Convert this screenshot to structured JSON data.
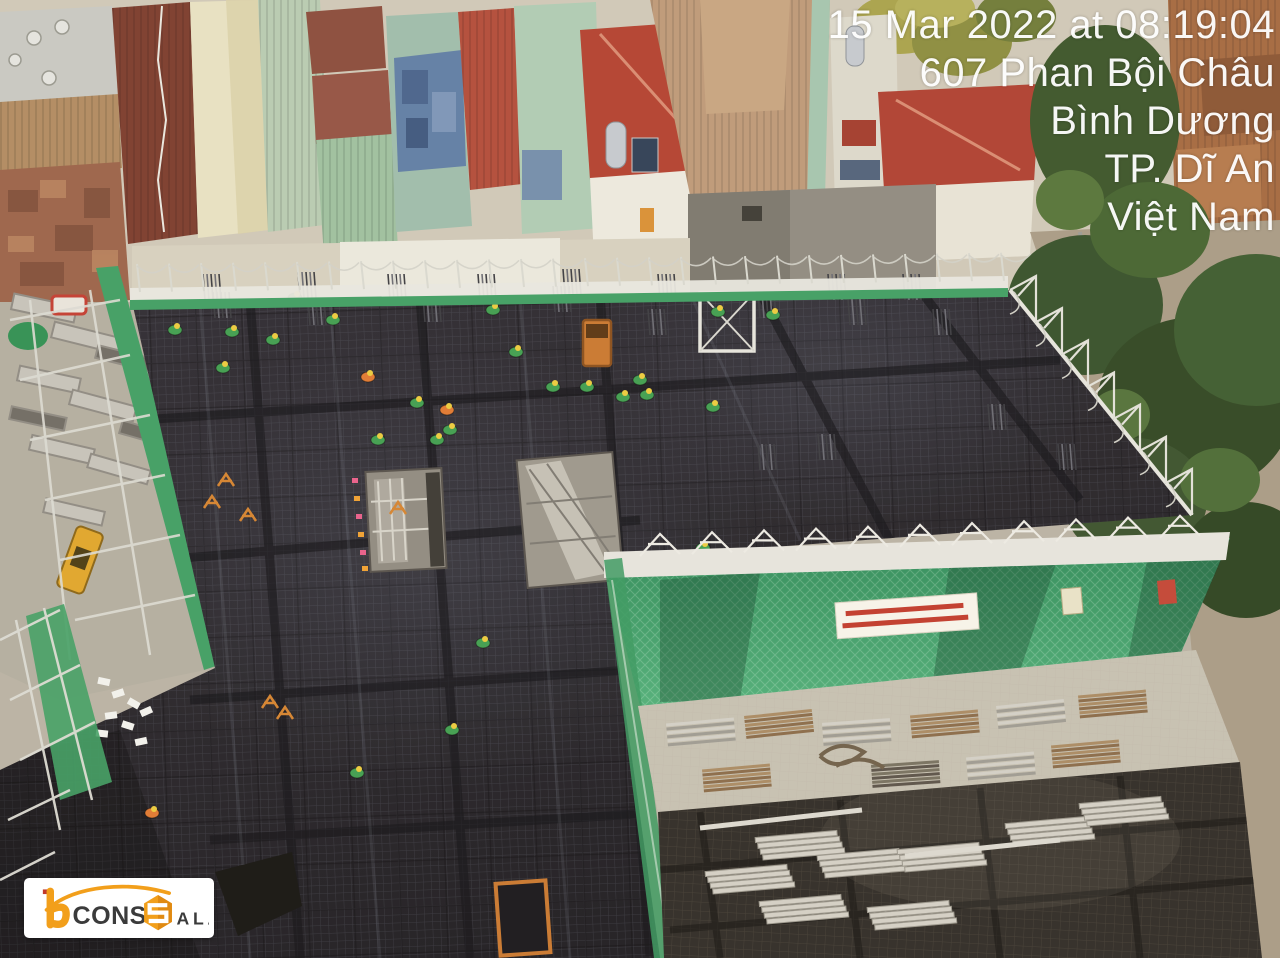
{
  "overlay": {
    "datetime": "15 Mar 2022 at 08:19:04",
    "address": "607 Phan Bội Châu",
    "province": "Bình Dương",
    "city": "TP. Dĩ An",
    "country": "Việt Nam"
  },
  "logo": {
    "word1": "CONS",
    "word2_initial": "S",
    "word2_rest": "ALA",
    "accent_color": "#F29F1B",
    "text_color": "#3B3B3B",
    "background": "#FFFFFF"
  },
  "palette": {
    "deck_dark": "#26232A",
    "deck_brown": "#332C26",
    "net_green": "#3F9E63",
    "scaffold_white": "#E8E7E0",
    "helmet_yellow": "#EBCB3D",
    "shirt_green": "#3F9E4F",
    "vest_orange": "#E07830",
    "timestamp_text": "#FFFFFF",
    "banner_bg": "#F7F4EA",
    "banner_text_red": "#C0392B",
    "hoist_bucket_orange": "#C9772E"
  },
  "scene": {
    "workers": [
      {
        "x": 232,
        "y": 332,
        "c": "g"
      },
      {
        "x": 223,
        "y": 368,
        "c": "g"
      },
      {
        "x": 273,
        "y": 340,
        "c": "g"
      },
      {
        "x": 295,
        "y": 298,
        "c": "g"
      },
      {
        "x": 333,
        "y": 320,
        "c": "g"
      },
      {
        "x": 368,
        "y": 377,
        "c": "o"
      },
      {
        "x": 378,
        "y": 440,
        "c": "g"
      },
      {
        "x": 417,
        "y": 403,
        "c": "g"
      },
      {
        "x": 447,
        "y": 410,
        "c": "o"
      },
      {
        "x": 450,
        "y": 430,
        "c": "g"
      },
      {
        "x": 437,
        "y": 440,
        "c": "g"
      },
      {
        "x": 493,
        "y": 310,
        "c": "g"
      },
      {
        "x": 516,
        "y": 352,
        "c": "g"
      },
      {
        "x": 553,
        "y": 387,
        "c": "g"
      },
      {
        "x": 587,
        "y": 387,
        "c": "g"
      },
      {
        "x": 623,
        "y": 397,
        "c": "g"
      },
      {
        "x": 640,
        "y": 380,
        "c": "g"
      },
      {
        "x": 647,
        "y": 395,
        "c": "g"
      },
      {
        "x": 713,
        "y": 407,
        "c": "g"
      },
      {
        "x": 773,
        "y": 315,
        "c": "g"
      },
      {
        "x": 718,
        "y": 312,
        "c": "g"
      },
      {
        "x": 483,
        "y": 643,
        "c": "g"
      },
      {
        "x": 452,
        "y": 730,
        "c": "g"
      },
      {
        "x": 357,
        "y": 773,
        "c": "g"
      },
      {
        "x": 152,
        "y": 813,
        "c": "o"
      },
      {
        "x": 703,
        "y": 548,
        "c": "g"
      },
      {
        "x": 922,
        "y": 807,
        "c": "g"
      },
      {
        "x": 175,
        "y": 330,
        "c": "g"
      },
      {
        "x": 973,
        "y": 890,
        "c": "o"
      }
    ]
  }
}
